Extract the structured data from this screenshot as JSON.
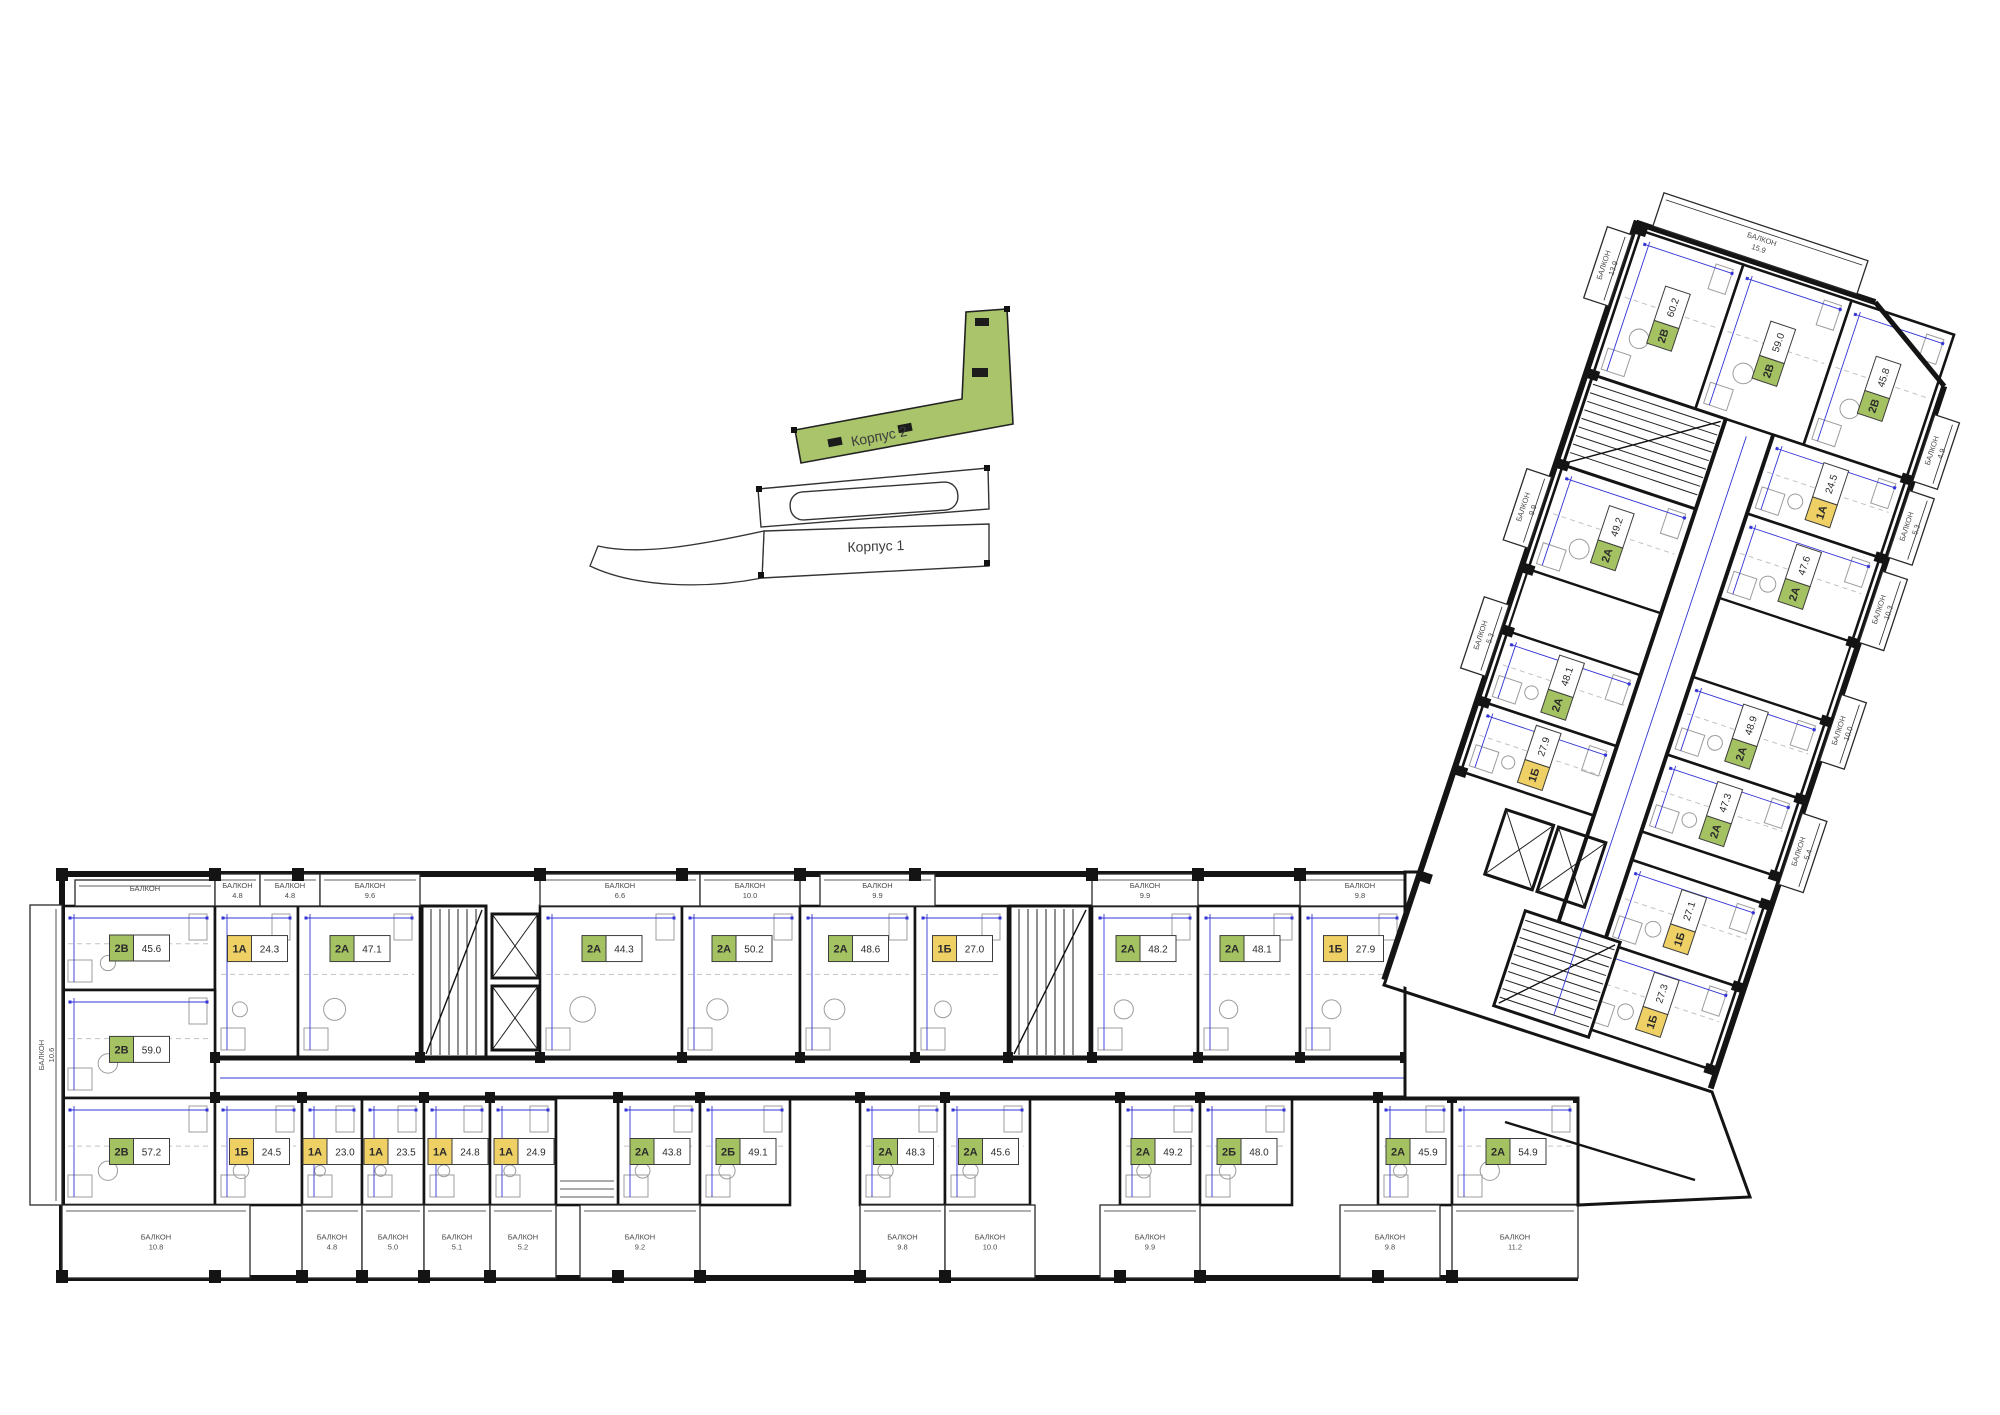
{
  "site_plan": {
    "korpus2_label": "Корпус 2",
    "korpus1_label": "Корпус 1",
    "highlight_color": "#a9c46a"
  },
  "colors": {
    "one_room_chip": "#eed064",
    "two_room_chip": "#a5c263",
    "wall": "#141414",
    "dimension_line": "#3434d6"
  },
  "balcony_word": "БАЛКОН",
  "floor_plan": {
    "left_block_unit": {
      "type": "2B",
      "area": "59.0"
    },
    "left_side_balcony": "10.6",
    "top_row": {
      "units": [
        {
          "type": "2B",
          "area": "45.6"
        },
        {
          "type": "1A",
          "area": "24.3"
        },
        {
          "type": "2A",
          "area": "47.1"
        },
        {
          "type": "2A",
          "area": "44.3"
        },
        {
          "type": "2A",
          "area": "50.2"
        },
        {
          "type": "2A",
          "area": "48.6"
        },
        {
          "type": "1Б",
          "area": "27.0"
        },
        {
          "type": "2A",
          "area": "48.2"
        },
        {
          "type": "2A",
          "area": "48.1"
        },
        {
          "type": "1Б",
          "area": "27.9"
        }
      ],
      "balconies": [
        "4.8",
        "4.8",
        "9.6",
        "6.6",
        "10.0",
        "9.9",
        "9.9",
        "9.8"
      ]
    },
    "bottom_row": {
      "units": [
        {
          "type": "2B",
          "area": "57.2"
        },
        {
          "type": "1Б",
          "area": "24.5"
        },
        {
          "type": "1A",
          "area": "23.0"
        },
        {
          "type": "1A",
          "area": "23.5"
        },
        {
          "type": "1A",
          "area": "24.8"
        },
        {
          "type": "1A",
          "area": "24.9"
        },
        {
          "type": "2A",
          "area": "43.8"
        },
        {
          "type": "2Б",
          "area": "49.1"
        },
        {
          "type": "2A",
          "area": "48.3"
        },
        {
          "type": "2A",
          "area": "45.6"
        },
        {
          "type": "2A",
          "area": "49.2"
        },
        {
          "type": "2Б",
          "area": "48.0"
        },
        {
          "type": "2A",
          "area": "45.9"
        },
        {
          "type": "2A",
          "area": "54.9"
        }
      ],
      "balconies": [
        "10.8",
        "4.8",
        "5.0",
        "5.1",
        "5.2",
        "9.2",
        "9.8",
        "10.0",
        "9.9",
        "9.8",
        "11.2"
      ]
    },
    "right_wing": {
      "top_band_units": [
        {
          "type": "2B",
          "area": "60.2"
        },
        {
          "type": "2B",
          "area": "59.0"
        },
        {
          "type": "2B",
          "area": "45.8"
        }
      ],
      "west_units": [
        {
          "type": "2A",
          "area": "49.2"
        },
        {
          "type": "2A",
          "area": "48.1"
        },
        {
          "type": "1Б",
          "area": "27.9"
        }
      ],
      "east_units": [
        {
          "type": "1A",
          "area": "24.5"
        },
        {
          "type": "2A",
          "area": "47.6"
        },
        {
          "type": "2A",
          "area": "48.9"
        },
        {
          "type": "2A",
          "area": "47.3"
        },
        {
          "type": "1Б",
          "area": "27.1"
        },
        {
          "type": "1Б",
          "area": "27.3"
        }
      ],
      "west_balconies": [
        "13.9",
        "9.9",
        "5.3"
      ],
      "east_balconies": [
        "4.9",
        "5.3",
        "10.3",
        "10.0",
        "5.4"
      ],
      "tip_balcony": "15.9"
    }
  }
}
